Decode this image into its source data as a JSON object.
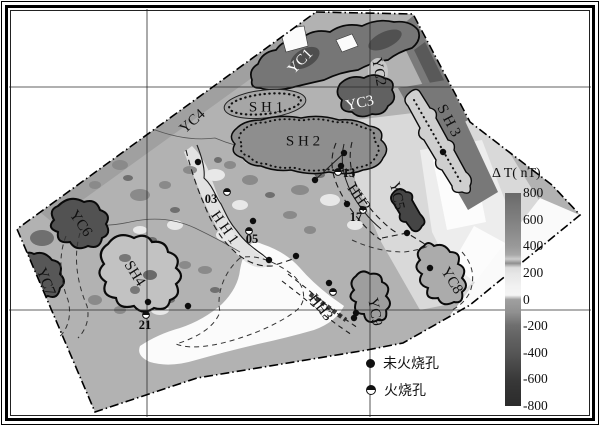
{
  "colorbar": {
    "title": "Δ T( nT)",
    "ticks": [
      "800",
      "600",
      "400",
      "200",
      "0",
      "-200",
      "-400",
      "-600",
      "-800"
    ],
    "gradient": [
      "#696969 0%",
      "#757575 6%",
      "#7f7f7f 12%",
      "#8d8d8d 19%",
      "#999999 25%",
      "#a8a8a8 29%",
      "#cccccc 31%",
      "#8f8f8f 33%",
      "#dcdcdc 35%",
      "#e6e6e6 38%",
      "#f2f2f2 44%",
      "#f4f4f4 48%",
      "#a0a0a0 50%",
      "#909090 56%",
      "#6f6f6f 62%",
      "#606060 69%",
      "#565656 75%",
      "#484848 81%",
      "#383838 88%",
      "#313131 94%",
      "#2c2c2c 100%"
    ]
  },
  "legend": {
    "items": [
      {
        "symbol": "filled-circle",
        "label": "未火烧孔"
      },
      {
        "symbol": "half-filled-circle",
        "label": "火烧孔"
      }
    ]
  },
  "map": {
    "boundary": [
      [
        316,
        12
      ],
      [
        413,
        14
      ],
      [
        470,
        122
      ],
      [
        552,
        185
      ],
      [
        580,
        215
      ],
      [
        470,
        305
      ],
      [
        403,
        343
      ],
      [
        367,
        350
      ],
      [
        300,
        361
      ],
      [
        197,
        378
      ],
      [
        95,
        412
      ],
      [
        17,
        229
      ]
    ],
    "grid": {
      "vertical_x": [
        147,
        370
      ],
      "horizontal_y": [
        87,
        310
      ]
    },
    "zone_labels": [
      {
        "text": "YC1",
        "x": 301,
        "y": 62,
        "rot": -46,
        "color": "#ffffff"
      },
      {
        "text": "YC2",
        "x": 378,
        "y": 72,
        "rot": 80
      },
      {
        "text": "YC3",
        "x": 360,
        "y": 104,
        "rot": -12,
        "color": "#ffffff"
      },
      {
        "text": "YC4",
        "x": 193,
        "y": 122,
        "rot": -42
      },
      {
        "text": "YC5",
        "x": 396,
        "y": 196,
        "rot": 78
      },
      {
        "text": "YC6",
        "x": 80,
        "y": 224,
        "rot": 55
      },
      {
        "text": "YC7",
        "x": 45,
        "y": 282,
        "rot": 68
      },
      {
        "text": "YC8",
        "x": 451,
        "y": 281,
        "rot": 58
      },
      {
        "text": "YC9",
        "x": 374,
        "y": 312,
        "rot": 80
      },
      {
        "text": "S H 1",
        "x": 266,
        "y": 108,
        "rot": 0
      },
      {
        "text": "S H 2",
        "x": 303,
        "y": 142,
        "rot": 0
      },
      {
        "text": "S H 3",
        "x": 448,
        "y": 121,
        "rot": 62
      },
      {
        "text": "SH4",
        "x": 134,
        "y": 274,
        "rot": 58
      },
      {
        "text": "H H 1",
        "x": 224,
        "y": 228,
        "rot": 55
      },
      {
        "text": "HH2",
        "x": 358,
        "y": 198,
        "rot": 55
      },
      {
        "text": "HH3",
        "x": 320,
        "y": 308,
        "rot": 52
      }
    ],
    "hole_labels": [
      {
        "text": "03",
        "x": 211,
        "y": 200
      },
      {
        "text": "05",
        "x": 252,
        "y": 240
      },
      {
        "text": "13",
        "x": 349,
        "y": 174
      },
      {
        "text": "17",
        "x": 356,
        "y": 218
      },
      {
        "text": "21",
        "x": 145,
        "y": 326
      }
    ],
    "holes": {
      "unburned": [
        [
          198,
          162
        ],
        [
          253,
          221
        ],
        [
          269,
          260
        ],
        [
          296,
          256
        ],
        [
          148,
          302
        ],
        [
          188,
          306
        ],
        [
          315,
          180
        ],
        [
          344,
          153
        ],
        [
          341,
          166
        ],
        [
          347,
          204
        ],
        [
          407,
          233
        ],
        [
          430,
          268
        ],
        [
          329,
          283
        ],
        [
          356,
          313
        ],
        [
          354,
          318
        ],
        [
          443,
          152
        ]
      ],
      "burned": [
        [
          227,
          192
        ],
        [
          249,
          231
        ],
        [
          146,
          315
        ],
        [
          363,
          210
        ],
        [
          333,
          292
        ],
        [
          338,
          172
        ]
      ]
    }
  }
}
